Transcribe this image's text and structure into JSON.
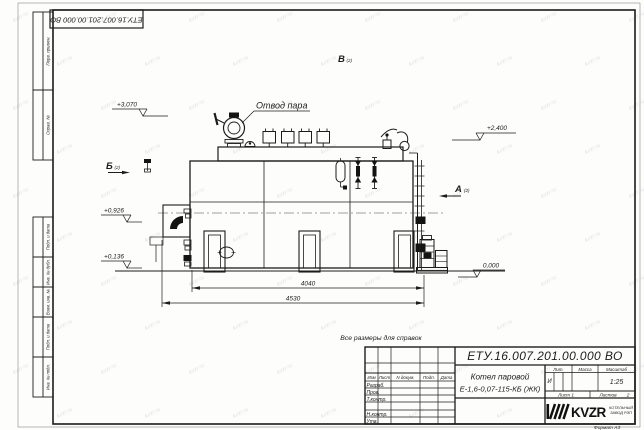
{
  "sheet": {
    "doc_number": "ЕТУ.16.007.201.00.000  ВО",
    "format_note": "Формат  А3",
    "ref_note": "Все размеры для справок",
    "watermark": "kvzr.ru"
  },
  "margin_labels": {
    "perv_primen": "Перв. примен.",
    "sprav_no": "Справ. №",
    "podp_data_1": "Подп. и дата",
    "inv_dubl": "Инв. № дубл.",
    "vzam_inv": "Взам. инв. №",
    "podp_data_2": "Подп. и дата",
    "inv_podl": "Инв. № подл."
  },
  "title_block": {
    "doc_number": "ЕТУ.16.007.201.00.000  ВО",
    "product_name_line1": "Котел паровой",
    "product_name_line2": "Е-1,6-0,07-115-КБ (ЖК)",
    "header": {
      "izm": "Изм",
      "list": "Лист",
      "n_dokum": "N докум.",
      "podp": "Подп.",
      "data": "Дата"
    },
    "rows": {
      "razrab": "Разраб.",
      "prov": "Пров.",
      "tkontr": "Т.контр.",
      "nkontr": "Н.контр.",
      "utv": "Утв."
    },
    "lit_header": "Лит.",
    "massa_header": "Масса",
    "masshtab_header": "Масштаб",
    "lit_value": "И",
    "masshtab_value": "1:25",
    "sheet_label": "Лист 1",
    "sheets_label": "Листов",
    "sheets_value": "2",
    "company_logo": "KVZR",
    "company_line1": "КОТЕЛЬНЫЙ",
    "company_line2": "ЗАВОД РЭП"
  },
  "drawing": {
    "callout_steam": "Отвод пара",
    "view_a": "А",
    "view_b": "Б",
    "view_v": "В",
    "view_ref": "(2)",
    "elev_3070": "+3,070",
    "elev_2400": "+2,400",
    "elev_0926": "+0,926",
    "elev_0136": "+0,136",
    "elev_0000": "0,000",
    "dim_inner": "4040",
    "dim_outer": "4530"
  },
  "colors": {
    "line": "#1c1c1c",
    "watermark": "#c3c9d4"
  }
}
